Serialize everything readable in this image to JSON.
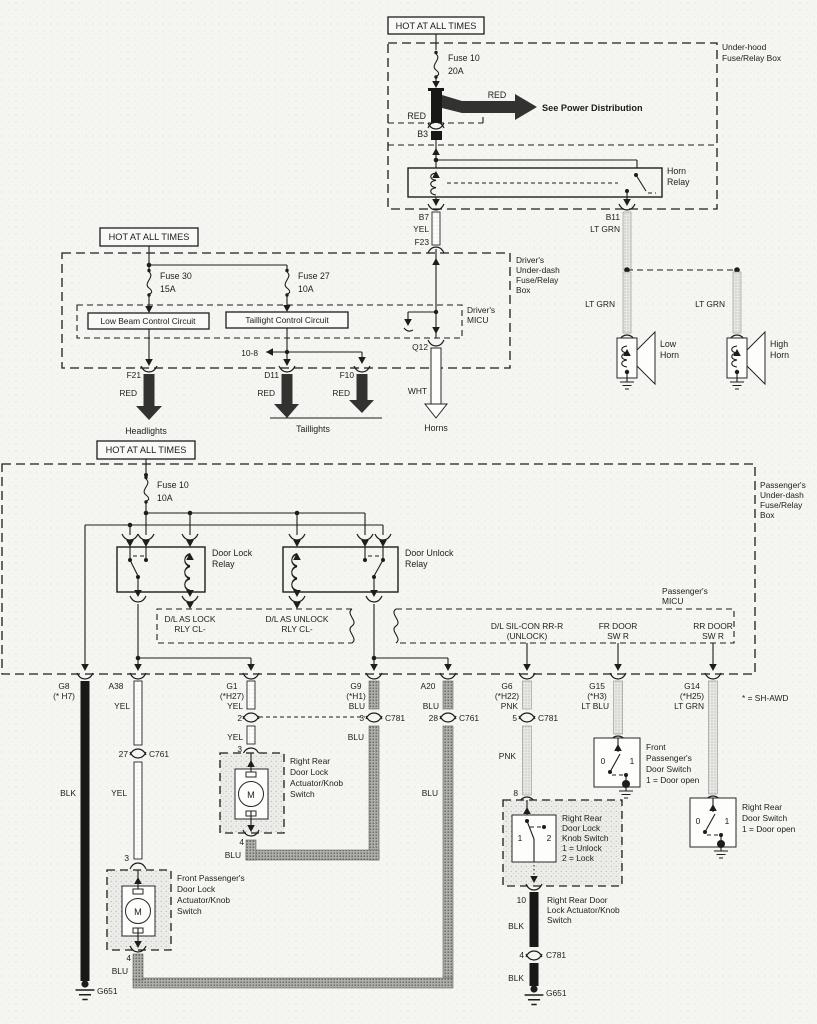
{
  "uh": {
    "hot": "HOT AT ALL TIMES",
    "box1": "Under-hood",
    "box2": "Fuse/Relay Box",
    "fuse": "Fuse 10",
    "amp": "20A",
    "red1": "RED",
    "red2": "RED",
    "see": "See Power Distribution",
    "b3": "B3",
    "relay1": "Horn",
    "relay2": "Relay",
    "b7": "B7",
    "yel": "YEL",
    "f23": "F23",
    "b11": "B11",
    "ltgrn": "LT GRN"
  },
  "horn": {
    "ltgrn_low": "LT GRN",
    "ltgrn_high": "LT GRN",
    "low1": "Low",
    "low2": "Horn",
    "high1": "High",
    "high2": "Horn"
  },
  "drv": {
    "hot": "HOT AT ALL TIMES",
    "box": [
      "Driver's",
      "Under-dash",
      "Fuse/Relay",
      "Box"
    ],
    "micu1": "Driver's",
    "micu2": "MICU",
    "f30": "Fuse 30",
    "f30a": "15A",
    "f27": "Fuse 27",
    "f27a": "10A",
    "lowbeam": "Low Beam Control Circuit",
    "tail": "Taillight Control Circuit",
    "ref": "10-8",
    "q12": "Q12",
    "f21": "F21",
    "f21c": "RED",
    "d11": "D11",
    "d11c": "RED",
    "f10": "F10",
    "f10c": "RED",
    "wht": "WHT",
    "headlights": "Headlights",
    "taillights": "Taillights",
    "horns": "Horns"
  },
  "pas": {
    "hot": "HOT AT ALL TIMES",
    "box": [
      "Passenger's",
      "Under-dash",
      "Fuse/Relay",
      "Box"
    ],
    "fuse": "Fuse 10",
    "amp": "10A",
    "lock1": "Door Lock",
    "lock2": "Relay",
    "unlock1": "Door Unlock",
    "unlock2": "Relay",
    "micu1": "Passenger's",
    "micu2": "MICU",
    "m_lock1": "D/L AS LOCK",
    "m_lock2": "RLY CL-",
    "m_unlock1": "D/L AS UNLOCK",
    "m_unlock2": "RLY CL-",
    "m_sil1": "D/L SIL-CON RR-R",
    "m_sil2": "(UNLOCK)",
    "m_fr1": "FR DOOR",
    "m_fr2": "SW R",
    "m_rr1": "RR DOOR",
    "m_rr2": "SW R",
    "awd": "* = SH-AWD"
  },
  "cols": {
    "g8": {
      "n1": "G8",
      "n2": "(* H7)",
      "c": "BLK",
      "gnd": "G651"
    },
    "a38": {
      "n1": "A38",
      "c1": "YEL",
      "p27": "27",
      "cn": "C761",
      "c2": "YEL",
      "p3": "3",
      "p4": "4",
      "c3": "BLU"
    },
    "g1": {
      "n1": "G1",
      "n2": "(*H27)",
      "c1": "YEL",
      "p2": "2",
      "c2": "YEL",
      "p3": "3",
      "p4": "4",
      "c3": "BLU"
    },
    "g9": {
      "n1": "G9",
      "n2": "(*H1)",
      "c1": "BLU",
      "p3": "3",
      "cn": "C781",
      "c2": "BLU"
    },
    "a20": {
      "n1": "A20",
      "c1": "BLU",
      "p28": "28",
      "cn": "C761",
      "c2": "BLU"
    },
    "g6": {
      "n1": "G6",
      "n2": "(*H22)",
      "c1": "PNK",
      "p5": "5",
      "cn": "C781",
      "c2": "PNK",
      "p8": "8"
    },
    "g15": {
      "n1": "G15",
      "n2": "(*H3)",
      "c1": "LT BLU"
    },
    "g14": {
      "n1": "G14",
      "n2": "(*H25)",
      "c1": "LT GRN"
    }
  },
  "comp": {
    "fp_act": [
      "Front Passenger's",
      "Door Lock",
      "Actuator/Knob",
      "Switch"
    ],
    "rr_act": [
      "Right Rear",
      "Door Lock",
      "Actuator/Knob",
      "Switch"
    ],
    "fp_sw": [
      "Front",
      "Passenger's",
      "Door Switch",
      "1 = Door open"
    ],
    "rr_sw": [
      "Right Rear",
      "Door Switch",
      "1 = Door open"
    ],
    "knob": [
      "Right Rear",
      "Door Lock",
      "Knob Switch",
      "1 = Unlock",
      "2 = Lock"
    ],
    "rr_act2": [
      "Right Rear Door",
      "Lock Actuator/Knob",
      "Switch"
    ],
    "knob_p1": "1",
    "knob_p2": "2",
    "sw0": "0",
    "sw1": "1",
    "p10": "10",
    "blk": "BLK",
    "p4": "4",
    "cn": "C781",
    "blk2": "BLK",
    "gnd": "G651",
    "motor": "M"
  }
}
